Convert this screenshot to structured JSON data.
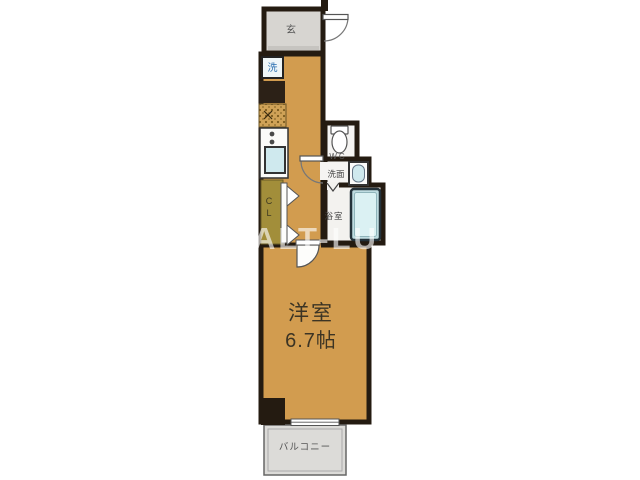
{
  "watermark": "ALT-LU",
  "plan": {
    "entrance_label": "玄",
    "washer_label": "洗",
    "closet_char1": "C",
    "closet_char2": "L",
    "wc_label": "WC",
    "washroom_label": "洗面",
    "bath_label": "浴室",
    "room_name": "洋室",
    "room_size": "6.7帖",
    "balcony_label": "バルコニー"
  },
  "colors": {
    "wall": "#241b11",
    "floor": "#d29c4f",
    "closet_floor": "#a28e3a",
    "entrance_floor": "#d7d5d1",
    "wet_floor": "#f5f4f2",
    "bath_floor": "#f3f2ef",
    "balcony_floor": "#dcdbd8",
    "tub_fill": "#dbf1f3",
    "tub_rim": "#bfdce1",
    "sink_fill": "#cfe9ee",
    "washer_fill": "#eef6f8"
  }
}
